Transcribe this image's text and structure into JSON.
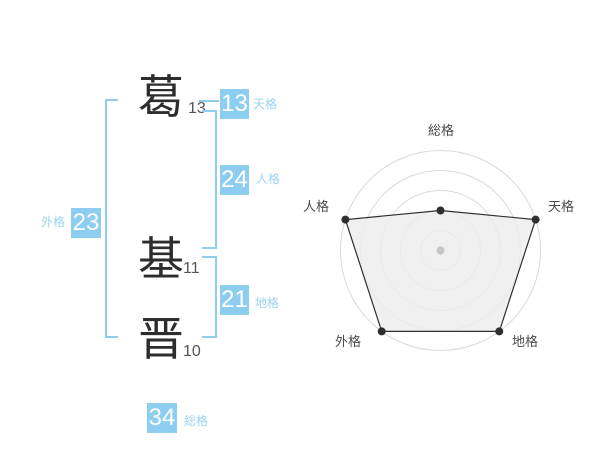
{
  "colors": {
    "accent": "#8ccdf0",
    "accent_label_text": "#9bd3f2",
    "badge_number_text": "#ffffff",
    "kanji_text": "#2d2d2d",
    "stroke_count_text": "#555555",
    "axis_label_text": "#4a4a4a",
    "background": "#ffffff"
  },
  "name": {
    "characters": [
      {
        "char": "葛",
        "strokes": "13"
      },
      {
        "char": "基",
        "strokes": "11"
      },
      {
        "char": "晋",
        "strokes": "10"
      }
    ]
  },
  "badges": {
    "tenkaku": {
      "value": "13",
      "label": "天格"
    },
    "jinkaku": {
      "value": "24",
      "label": "人格"
    },
    "chikaku": {
      "value": "21",
      "label": "地格"
    },
    "gaikaku": {
      "value": "23",
      "label": "外格"
    },
    "soukaku": {
      "value": "34",
      "label": "総格"
    }
  },
  "chart_data": {
    "type": "radar",
    "axes": [
      "総格",
      "天格",
      "地格",
      "外格",
      "人格"
    ],
    "values": [
      2,
      5,
      5,
      5,
      5
    ],
    "max": 5,
    "rings": 5,
    "start_angle_deg": 90,
    "direction": "clockwise",
    "grid": "circular",
    "legend": false,
    "ring_color": "#d9d9d9",
    "fill_color": "#ececec",
    "fill_opacity": 0.8,
    "line_color": "#2f2f2f",
    "dot_color": "#2f2f2f",
    "center_dot_color": "#c4c4c4"
  }
}
